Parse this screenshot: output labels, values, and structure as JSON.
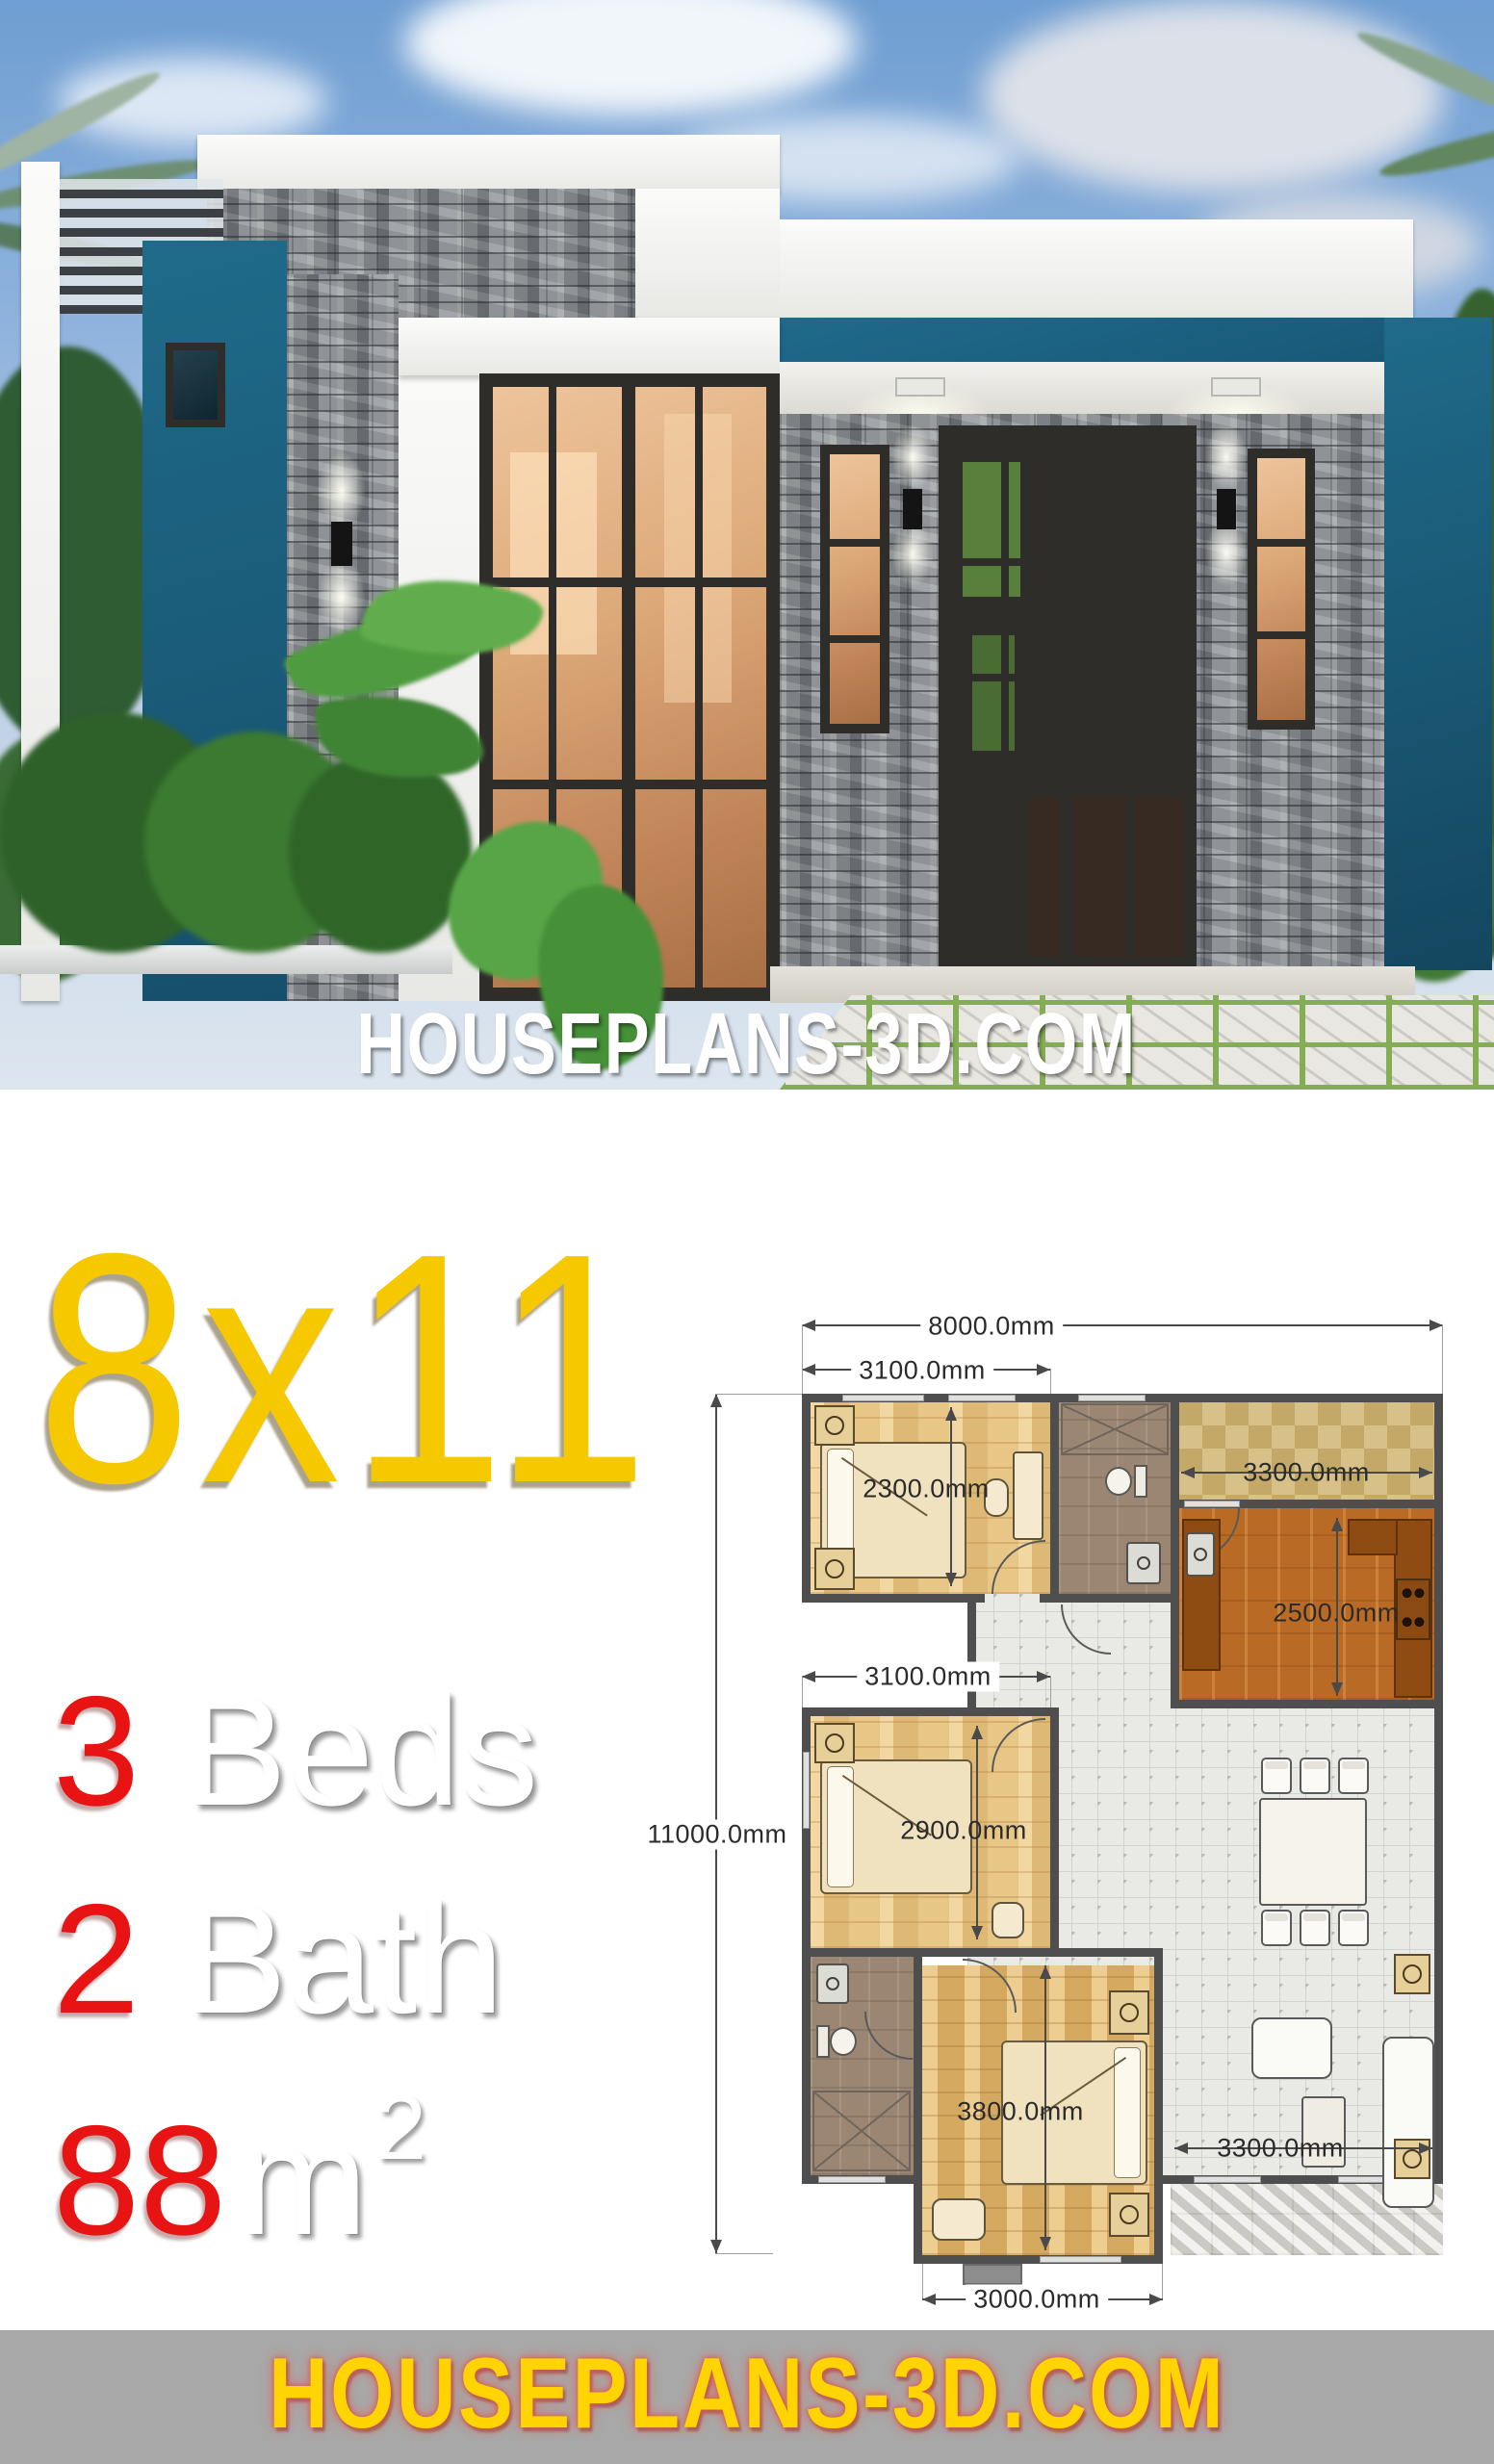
{
  "poster": {
    "hero_title": "HOUSEPLANS-3D.COM",
    "footer_title": "HOUSEPLANS-3D.COM",
    "accent_yellow": "#f6c800",
    "accent_red": "#e81414",
    "footer_bg": "#a8a8a8",
    "teal": "#1d6485"
  },
  "specs": {
    "size_label": "8x11",
    "rows": [
      {
        "number": "3",
        "label": "Beds"
      },
      {
        "number": "2",
        "label": "Bath"
      },
      {
        "number": "88",
        "label": "m",
        "sup": "2"
      }
    ]
  },
  "floor_plan": {
    "dims": {
      "overall_width": "8000.0mm",
      "overall_depth": "11000.0mm",
      "bedroom1_width": "3100.0mm",
      "bedroom1_depth": "2300.0mm",
      "terrace_width": "3300.0mm",
      "kitchen_depth": "2500.0mm",
      "bedroom2_width": "3100.0mm",
      "bedroom2_depth": "2900.0mm",
      "master_bedroom_depth": "3800.0mm",
      "living_width": "3300.0mm",
      "master_bedroom_width": "3000.0mm"
    }
  }
}
